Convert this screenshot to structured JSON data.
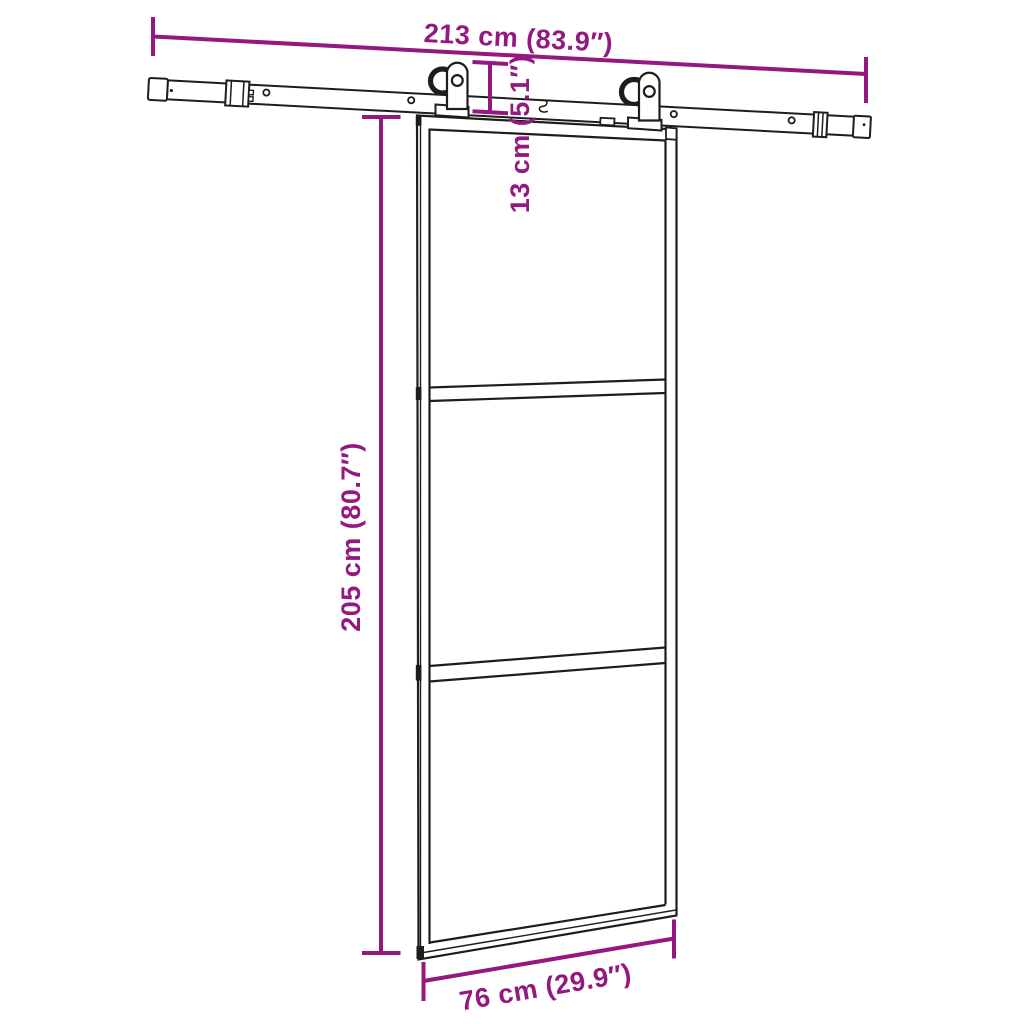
{
  "diagram": {
    "colors": {
      "line": "#1d1d1b",
      "dimension": "#94187F",
      "background": "#ffffff"
    },
    "labels": {
      "rail_width": "213 cm (83.9″)",
      "hardware_height": "13 cm (5.1″)",
      "door_height": "205 cm (80.7″)",
      "door_width": "76 cm (29.9″)"
    },
    "values": {
      "rail_width_cm": 213,
      "rail_width_in": 83.9,
      "hardware_height_cm": 13,
      "hardware_height_in": 5.1,
      "door_height_cm": 205,
      "door_height_in": 80.7,
      "door_width_cm": 76,
      "door_width_in": 29.9
    }
  }
}
